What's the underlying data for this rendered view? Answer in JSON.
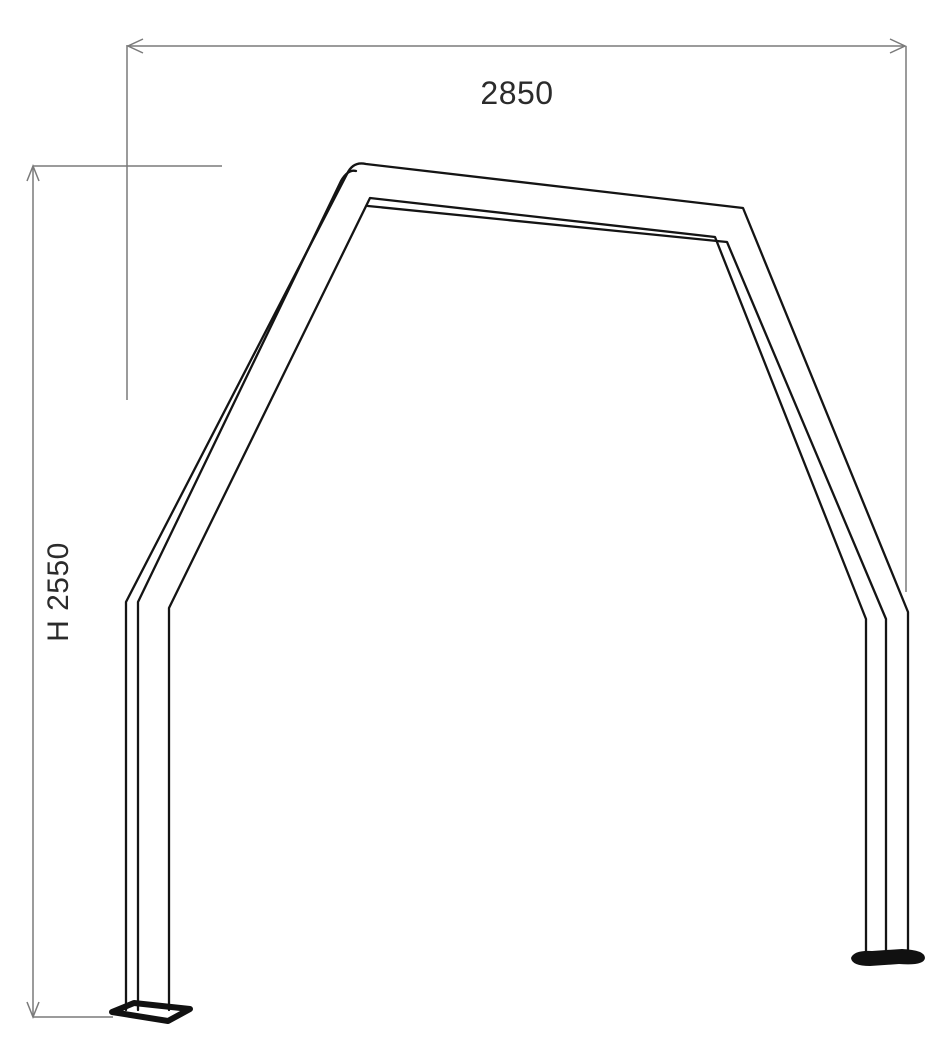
{
  "colors": {
    "structure_line": "#141414",
    "dimension_line": "#7a7a7a",
    "base_plate": "#111111",
    "text": "#2b2b2b",
    "background": "#ffffff"
  },
  "dimensions": {
    "width": {
      "label": "2850"
    },
    "height": {
      "label": "H 2550"
    }
  }
}
